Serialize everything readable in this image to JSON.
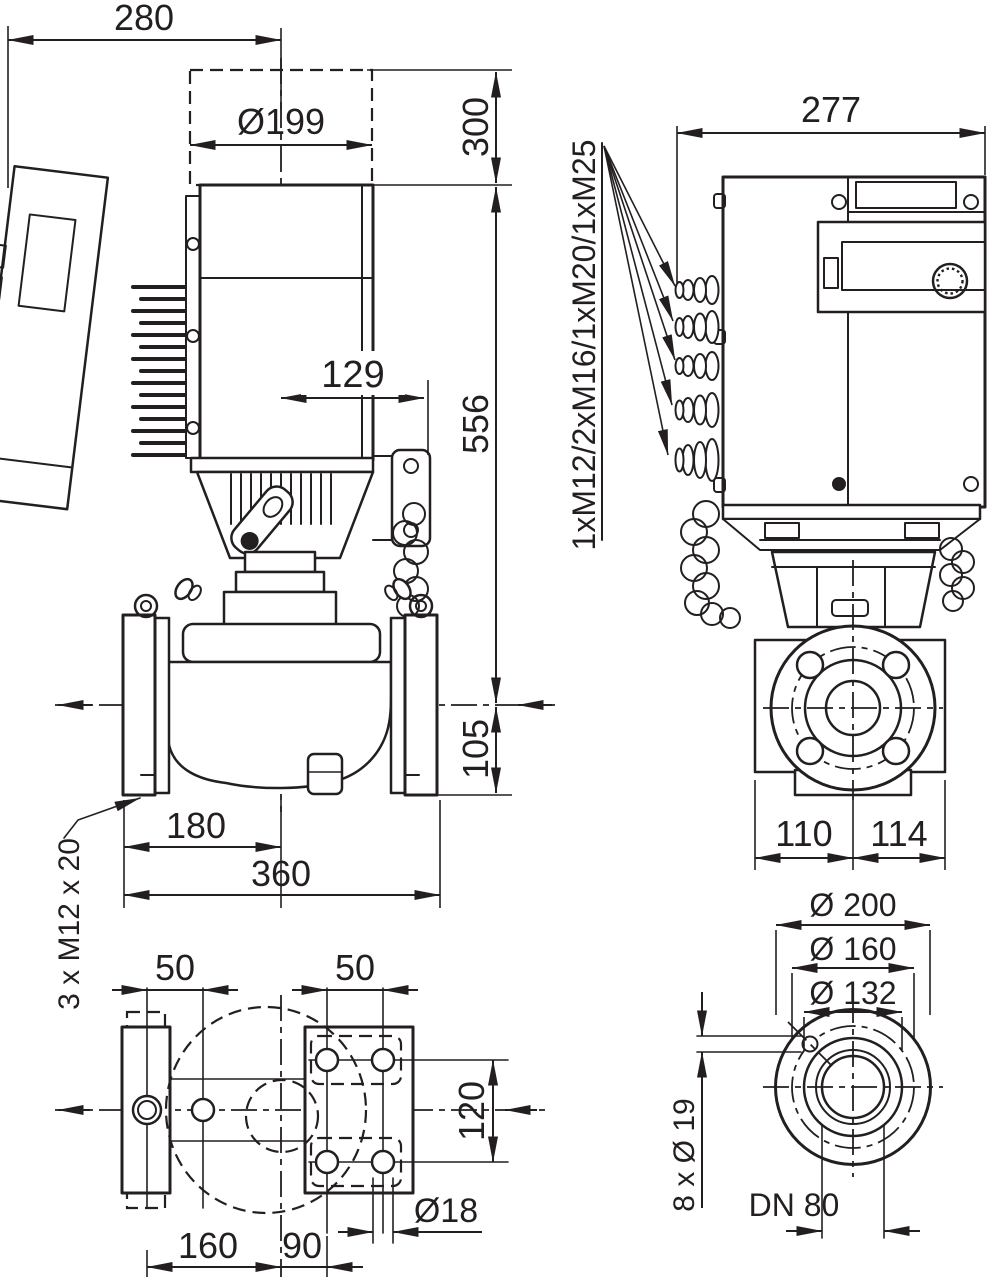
{
  "colors": {
    "ink": "#231f20",
    "background": "#ffffff"
  },
  "side_view": {
    "dim_width_overall": "280",
    "dim_fan_cover_diameter": "Ø199",
    "dim_removal_clearance": "300",
    "dim_module_offset": "129",
    "dim_height_axis_to_top": "556",
    "dim_axis_to_base": "105",
    "dim_foot_hole_to_axis": "180",
    "dim_foot_span": "360",
    "note_foot_thread": "3 x M12 x 20"
  },
  "rear_view": {
    "dim_width_overall": "277",
    "label_cable_glands": "1xM12/2xM16/1xM20/1xM25",
    "dim_axis_to_left": "110",
    "dim_axis_to_right": "114"
  },
  "foot_plan_view": {
    "dim_hole_pitch_left": "50",
    "dim_hole_pitch_right": "50",
    "dim_hole_row_spacing": "120",
    "dim_hole_diameter": "Ø18",
    "dim_left_holes_to_axis": "160",
    "dim_axis_to_right_holes": "90"
  },
  "flange_view": {
    "dim_outer_diameter": "Ø 200",
    "dim_bolt_circle": "Ø 160",
    "dim_raised_face": "Ø 132",
    "label_bolt_holes": "8 x Ø 19",
    "label_nominal_bore": "DN 80"
  }
}
